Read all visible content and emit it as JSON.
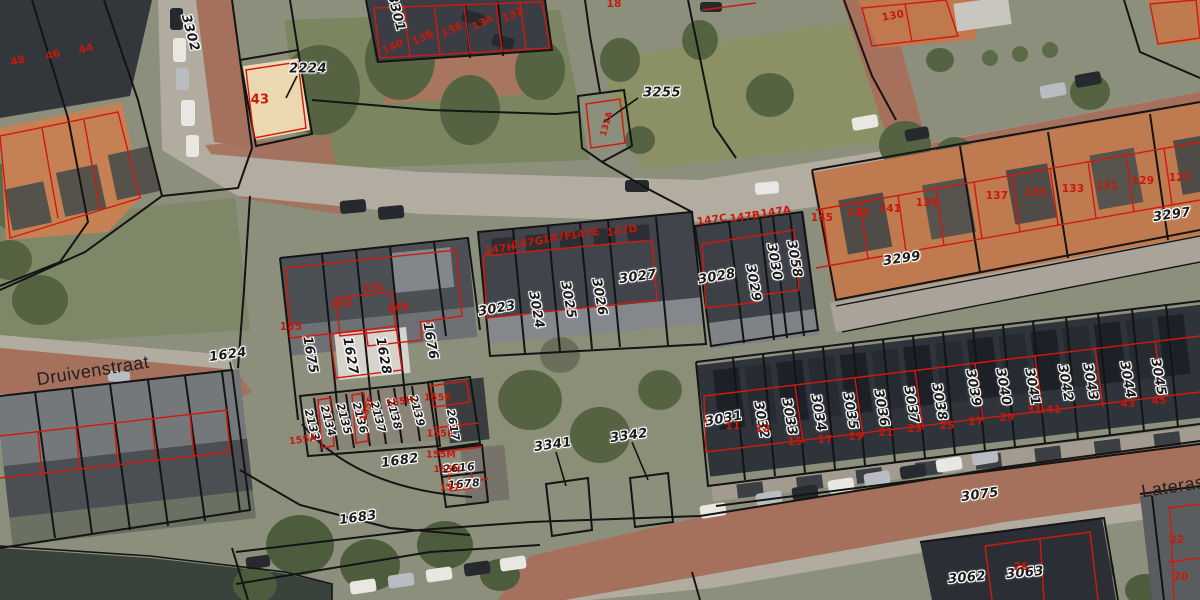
{
  "map": {
    "streets": [
      {
        "text": "Druivenstraat",
        "x": 93,
        "y": 371,
        "rot": -9,
        "kind": "street"
      },
      {
        "text": "Laterastraat",
        "x": 1192,
        "y": 484,
        "rot": -9,
        "kind": "street"
      }
    ],
    "parcel_labels": [
      {
        "text": "3302",
        "x": 190,
        "y": 33,
        "rot": 75,
        "kind": "parcel"
      },
      {
        "text": "3301",
        "x": 396,
        "y": 13,
        "rot": 75,
        "kind": "parcel"
      },
      {
        "text": "2224",
        "x": 308,
        "y": 69,
        "rot": 0,
        "kind": "parcel"
      },
      {
        "text": "3255",
        "x": 662,
        "y": 93,
        "rot": 0,
        "kind": "parcel"
      },
      {
        "text": "3023",
        "x": 497,
        "y": 309,
        "rot": -10,
        "kind": "parcel"
      },
      {
        "text": "3024",
        "x": 536,
        "y": 310,
        "rot": 80,
        "kind": "parcel"
      },
      {
        "text": "3025",
        "x": 568,
        "y": 300,
        "rot": 80,
        "kind": "parcel"
      },
      {
        "text": "3026",
        "x": 599,
        "y": 297,
        "rot": 80,
        "kind": "parcel"
      },
      {
        "text": "3027",
        "x": 638,
        "y": 277,
        "rot": -8,
        "kind": "parcel"
      },
      {
        "text": "3028",
        "x": 717,
        "y": 277,
        "rot": -10,
        "kind": "parcel"
      },
      {
        "text": "3029",
        "x": 753,
        "y": 283,
        "rot": 80,
        "kind": "parcel"
      },
      {
        "text": "3030",
        "x": 774,
        "y": 262,
        "rot": 80,
        "kind": "parcel"
      },
      {
        "text": "3058",
        "x": 794,
        "y": 259,
        "rot": 80,
        "kind": "parcel"
      },
      {
        "text": "3299",
        "x": 902,
        "y": 259,
        "rot": -8,
        "kind": "parcel"
      },
      {
        "text": "3297",
        "x": 1172,
        "y": 215,
        "rot": -8,
        "kind": "parcel"
      },
      {
        "text": "1624",
        "x": 228,
        "y": 355,
        "rot": -8,
        "kind": "parcel"
      },
      {
        "text": "1675",
        "x": 310,
        "y": 355,
        "rot": 80,
        "kind": "parcel"
      },
      {
        "text": "1627",
        "x": 350,
        "y": 356,
        "rot": 80,
        "kind": "parcel"
      },
      {
        "text": "1628",
        "x": 383,
        "y": 356,
        "rot": 80,
        "kind": "parcel"
      },
      {
        "text": "1676",
        "x": 430,
        "y": 341,
        "rot": 80,
        "kind": "parcel"
      },
      {
        "text": "2133",
        "x": 312,
        "y": 425,
        "rot": 75,
        "kind": "parcel",
        "size": 11
      },
      {
        "text": "2134",
        "x": 328,
        "y": 421,
        "rot": 75,
        "kind": "parcel",
        "size": 11
      },
      {
        "text": "2135",
        "x": 344,
        "y": 419,
        "rot": 75,
        "kind": "parcel",
        "size": 11
      },
      {
        "text": "2136",
        "x": 360,
        "y": 418,
        "rot": 75,
        "kind": "parcel",
        "size": 11
      },
      {
        "text": "2137",
        "x": 378,
        "y": 417,
        "rot": 75,
        "kind": "parcel",
        "size": 11
      },
      {
        "text": "2138",
        "x": 394,
        "y": 414,
        "rot": 75,
        "kind": "parcel",
        "size": 11
      },
      {
        "text": "2139",
        "x": 417,
        "y": 411,
        "rot": 75,
        "kind": "parcel",
        "size": 11
      },
      {
        "text": "2617",
        "x": 453,
        "y": 425,
        "rot": 80,
        "kind": "parcel",
        "size": 11
      },
      {
        "text": "2616",
        "x": 459,
        "y": 468,
        "rot": -5,
        "kind": "parcel",
        "size": 11
      },
      {
        "text": "1678",
        "x": 464,
        "y": 484,
        "rot": -5,
        "kind": "parcel",
        "size": 11
      },
      {
        "text": "1682",
        "x": 400,
        "y": 461,
        "rot": -8,
        "kind": "parcel"
      },
      {
        "text": "1683",
        "x": 358,
        "y": 518,
        "rot": -8,
        "kind": "parcel"
      },
      {
        "text": "3341",
        "x": 553,
        "y": 445,
        "rot": -8,
        "kind": "parcel"
      },
      {
        "text": "3342",
        "x": 629,
        "y": 436,
        "rot": -8,
        "kind": "parcel"
      },
      {
        "text": "3031",
        "x": 724,
        "y": 419,
        "rot": -10,
        "kind": "parcel"
      },
      {
        "text": "3032",
        "x": 761,
        "y": 420,
        "rot": 80,
        "kind": "parcel"
      },
      {
        "text": "3033",
        "x": 789,
        "y": 417,
        "rot": 80,
        "kind": "parcel"
      },
      {
        "text": "3034",
        "x": 818,
        "y": 413,
        "rot": 80,
        "kind": "parcel"
      },
      {
        "text": "3035",
        "x": 850,
        "y": 411,
        "rot": 80,
        "kind": "parcel"
      },
      {
        "text": "3036",
        "x": 881,
        "y": 408,
        "rot": 80,
        "kind": "parcel"
      },
      {
        "text": "3037",
        "x": 911,
        "y": 405,
        "rot": 80,
        "kind": "parcel"
      },
      {
        "text": "3038",
        "x": 939,
        "y": 402,
        "rot": 80,
        "kind": "parcel"
      },
      {
        "text": "3039",
        "x": 973,
        "y": 388,
        "rot": 80,
        "kind": "parcel"
      },
      {
        "text": "3040",
        "x": 1003,
        "y": 387,
        "rot": 80,
        "kind": "parcel"
      },
      {
        "text": "3041",
        "x": 1032,
        "y": 387,
        "rot": 80,
        "kind": "parcel"
      },
      {
        "text": "3042",
        "x": 1065,
        "y": 383,
        "rot": 80,
        "kind": "parcel"
      },
      {
        "text": "3043",
        "x": 1090,
        "y": 382,
        "rot": 80,
        "kind": "parcel"
      },
      {
        "text": "3044",
        "x": 1127,
        "y": 380,
        "rot": 80,
        "kind": "parcel"
      },
      {
        "text": "3045",
        "x": 1158,
        "y": 377,
        "rot": 80,
        "kind": "parcel"
      },
      {
        "text": "3075",
        "x": 980,
        "y": 495,
        "rot": -8,
        "kind": "parcel"
      },
      {
        "text": "3062",
        "x": 967,
        "y": 578,
        "rot": -5,
        "kind": "parcel"
      },
      {
        "text": "3063",
        "x": 1025,
        "y": 573,
        "rot": -5,
        "kind": "parcel"
      }
    ],
    "house_numbers": [
      {
        "text": "48",
        "x": 18,
        "y": 61,
        "rot": -15,
        "kind": "house"
      },
      {
        "text": "46",
        "x": 53,
        "y": 55,
        "rot": -15,
        "kind": "house"
      },
      {
        "text": "44",
        "x": 86,
        "y": 49,
        "rot": -15,
        "kind": "house"
      },
      {
        "text": "43",
        "x": 260,
        "y": 100,
        "rot": 0,
        "kind": "house",
        "size": 13
      },
      {
        "text": "140",
        "x": 393,
        "y": 47,
        "rot": -25,
        "kind": "house"
      },
      {
        "text": "138",
        "x": 423,
        "y": 38,
        "rot": -25,
        "kind": "house"
      },
      {
        "text": "136",
        "x": 452,
        "y": 30,
        "rot": -25,
        "kind": "house"
      },
      {
        "text": "134",
        "x": 483,
        "y": 23,
        "rot": -25,
        "kind": "house"
      },
      {
        "text": "132",
        "x": 513,
        "y": 15,
        "rot": -25,
        "kind": "house"
      },
      {
        "text": "18",
        "x": 614,
        "y": 4,
        "rot": 0,
        "kind": "house"
      },
      {
        "text": "130",
        "x": 893,
        "y": 16,
        "rot": -10,
        "kind": "house"
      },
      {
        "text": "132A",
        "x": 607,
        "y": 124,
        "rot": -75,
        "kind": "house",
        "size": 8.5
      },
      {
        "text": "147H",
        "x": 500,
        "y": 249,
        "rot": -8,
        "kind": "house"
      },
      {
        "text": "147G",
        "x": 528,
        "y": 243,
        "rot": -8,
        "kind": "house"
      },
      {
        "text": "147F",
        "x": 557,
        "y": 238,
        "rot": -8,
        "kind": "house"
      },
      {
        "text": "147E",
        "x": 585,
        "y": 234,
        "rot": -8,
        "kind": "house"
      },
      {
        "text": "147D",
        "x": 622,
        "y": 231,
        "rot": -8,
        "kind": "house"
      },
      {
        "text": "147C",
        "x": 712,
        "y": 220,
        "rot": -8,
        "kind": "house"
      },
      {
        "text": "147B",
        "x": 745,
        "y": 217,
        "rot": -8,
        "kind": "house"
      },
      {
        "text": "147A",
        "x": 776,
        "y": 212,
        "rot": -8,
        "kind": "house"
      },
      {
        "text": "145",
        "x": 822,
        "y": 218,
        "rot": 0,
        "kind": "house"
      },
      {
        "text": "143",
        "x": 858,
        "y": 213,
        "rot": 0,
        "kind": "house"
      },
      {
        "text": "141",
        "x": 890,
        "y": 209,
        "rot": 0,
        "kind": "house"
      },
      {
        "text": "139",
        "x": 927,
        "y": 203,
        "rot": 0,
        "kind": "house"
      },
      {
        "text": "137",
        "x": 997,
        "y": 196,
        "rot": 0,
        "kind": "house"
      },
      {
        "text": "135",
        "x": 1036,
        "y": 193,
        "rot": 0,
        "kind": "house"
      },
      {
        "text": "133",
        "x": 1073,
        "y": 189,
        "rot": 0,
        "kind": "house"
      },
      {
        "text": "131",
        "x": 1107,
        "y": 186,
        "rot": 0,
        "kind": "house"
      },
      {
        "text": "129",
        "x": 1143,
        "y": 181,
        "rot": 0,
        "kind": "house"
      },
      {
        "text": "127",
        "x": 1180,
        "y": 178,
        "rot": 0,
        "kind": "house"
      },
      {
        "text": "155",
        "x": 291,
        "y": 327,
        "rot": 0,
        "kind": "house"
      },
      {
        "text": "153",
        "x": 342,
        "y": 304,
        "rot": -8,
        "kind": "house"
      },
      {
        "text": "151",
        "x": 374,
        "y": 288,
        "rot": -8,
        "kind": "house"
      },
      {
        "text": "149",
        "x": 398,
        "y": 308,
        "rot": -8,
        "kind": "house"
      },
      {
        "text": "155A",
        "x": 303,
        "y": 440,
        "rot": -8,
        "kind": "house",
        "size": 9.5
      },
      {
        "text": "155F",
        "x": 368,
        "y": 409,
        "rot": -70,
        "kind": "house",
        "size": 9
      },
      {
        "text": "155H",
        "x": 400,
        "y": 402,
        "rot": -8,
        "kind": "house",
        "size": 9.5
      },
      {
        "text": "155K",
        "x": 438,
        "y": 398,
        "rot": 0,
        "kind": "house",
        "size": 9.5
      },
      {
        "text": "155L",
        "x": 440,
        "y": 434,
        "rot": 0,
        "kind": "house",
        "size": 9.5
      },
      {
        "text": "155M",
        "x": 441,
        "y": 455,
        "rot": 0,
        "kind": "house",
        "size": 9.5
      },
      {
        "text": "155N",
        "x": 447,
        "y": 470,
        "rot": 0,
        "kind": "house",
        "size": 9
      },
      {
        "text": "157",
        "x": 450,
        "y": 488,
        "rot": 0,
        "kind": "house",
        "size": 9.5
      },
      {
        "text": "11",
        "x": 733,
        "y": 426,
        "rot": 0,
        "kind": "house"
      },
      {
        "text": "13",
        "x": 763,
        "y": 429,
        "rot": 0,
        "kind": "house"
      },
      {
        "text": "15",
        "x": 795,
        "y": 442,
        "rot": 0,
        "kind": "house"
      },
      {
        "text": "17",
        "x": 825,
        "y": 440,
        "rot": 0,
        "kind": "house"
      },
      {
        "text": "19",
        "x": 856,
        "y": 437,
        "rot": 0,
        "kind": "house"
      },
      {
        "text": "21",
        "x": 886,
        "y": 433,
        "rot": 0,
        "kind": "house"
      },
      {
        "text": "23",
        "x": 915,
        "y": 429,
        "rot": 0,
        "kind": "house"
      },
      {
        "text": "25",
        "x": 947,
        "y": 426,
        "rot": 0,
        "kind": "house"
      },
      {
        "text": "27",
        "x": 976,
        "y": 422,
        "rot": 0,
        "kind": "house"
      },
      {
        "text": "29",
        "x": 1007,
        "y": 418,
        "rot": 0,
        "kind": "house"
      },
      {
        "text": "31-41",
        "x": 1044,
        "y": 410,
        "rot": 0,
        "kind": "house"
      },
      {
        "text": "43",
        "x": 1128,
        "y": 404,
        "rot": 0,
        "kind": "house"
      },
      {
        "text": "45",
        "x": 1159,
        "y": 401,
        "rot": 0,
        "kind": "house"
      },
      {
        "text": "26",
        "x": 1021,
        "y": 567,
        "rot": 0,
        "kind": "house"
      },
      {
        "text": "22",
        "x": 1177,
        "y": 540,
        "rot": 0,
        "kind": "house"
      },
      {
        "text": "20",
        "x": 1181,
        "y": 577,
        "rot": 0,
        "kind": "house"
      }
    ],
    "colors": {
      "parcel_boundary": "#141414",
      "building_outline": "#d2190e",
      "parcel_label": "#1b1b1b",
      "house_number": "#c8180b"
    }
  }
}
